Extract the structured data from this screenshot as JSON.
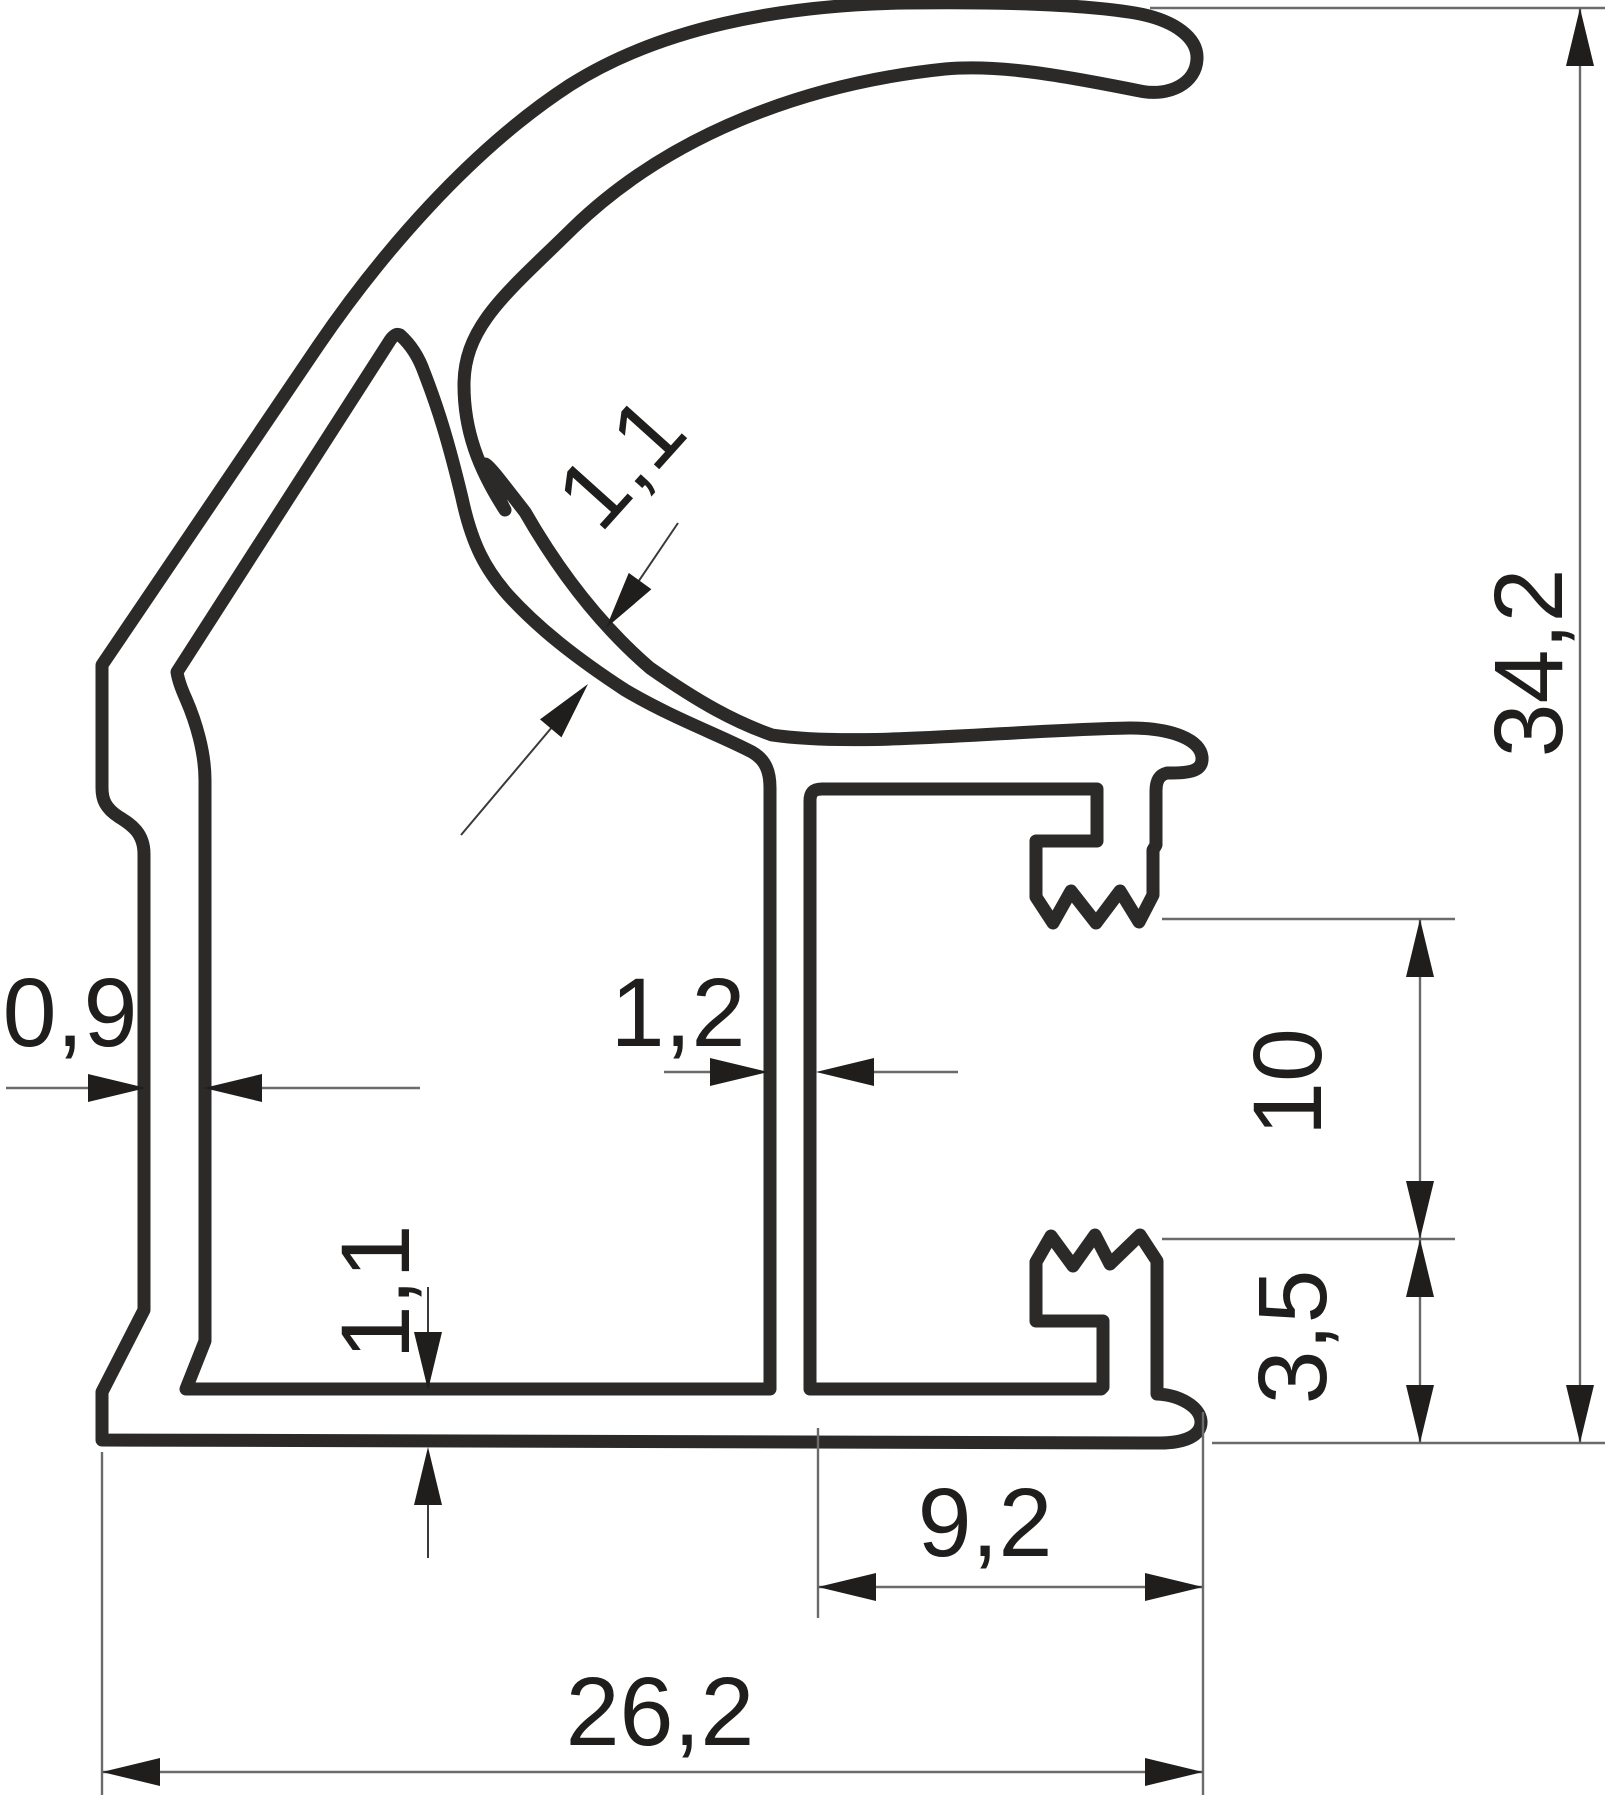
{
  "drawing": {
    "type": "technical-cross-section",
    "subject": "c-handle-aluminium-profile",
    "background": "#ffffff",
    "colors": {
      "outline": "#2b2a29",
      "dimension_lines": "#6b6b6b",
      "text": "#1f1e1d"
    },
    "dimensions": {
      "c_wall_thickness": "1,1",
      "overall_height": "34,2",
      "left_wall_thickness": "0,9",
      "center_rib_thickness": "1,2",
      "hook_opening": "10",
      "bottom_wall_thickness": "1,1",
      "lower_hook_offset": "3,5",
      "groove_width": "9,2",
      "overall_width": "26,2"
    }
  }
}
